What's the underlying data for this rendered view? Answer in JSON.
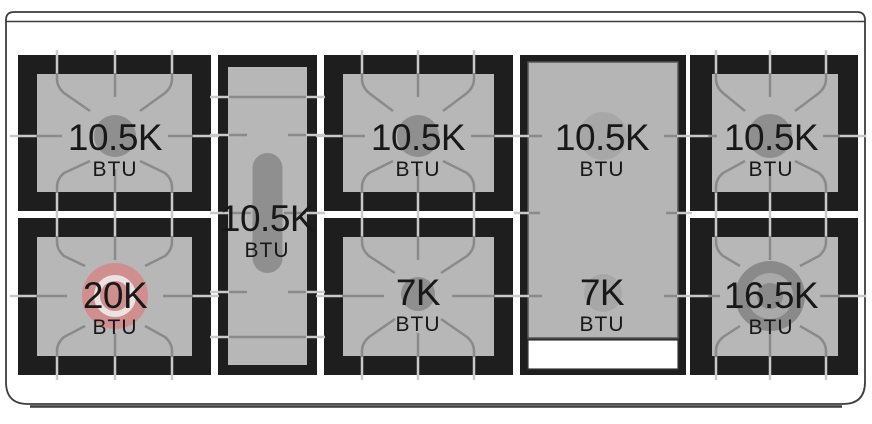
{
  "diagram": {
    "kind": "gas range cooktop burner layout",
    "unit_label": "BTU"
  },
  "burners": {
    "left_rear": {
      "output": "10.5K",
      "unit": "BTU"
    },
    "left_front": {
      "output": "20K",
      "unit": "BTU"
    },
    "center": {
      "output": "10.5K",
      "unit": "BTU"
    },
    "mid_rear": {
      "output": "10.5K",
      "unit": "BTU"
    },
    "mid_front": {
      "output": "7K",
      "unit": "BTU"
    },
    "griddle_rear": {
      "output": "10.5K",
      "unit": "BTU"
    },
    "griddle_front": {
      "output": "7K",
      "unit": "BTU"
    },
    "right_rear": {
      "output": "10.5K",
      "unit": "BTU"
    },
    "right_front": {
      "output": "16.5K",
      "unit": "BTU"
    }
  },
  "colors": {
    "surface_white": "#ffffff",
    "section_black": "#1e1e1e",
    "plate_gray": "#b7b7b7",
    "burner_gray": "#8f8f8f",
    "griddle_burner_gray": "#a7a7a7",
    "burner_20k_pink": "#cf8f8f",
    "burner_20k_ring": "#ece2e2",
    "burner_16k_dark": "#8a8a8a",
    "burner_16k_ring": "#a9a9a9",
    "grate_line_dark": "#8a8a8a",
    "grate_line_light": "#c9c9c9",
    "outline_gray": "#3d3d3d"
  }
}
